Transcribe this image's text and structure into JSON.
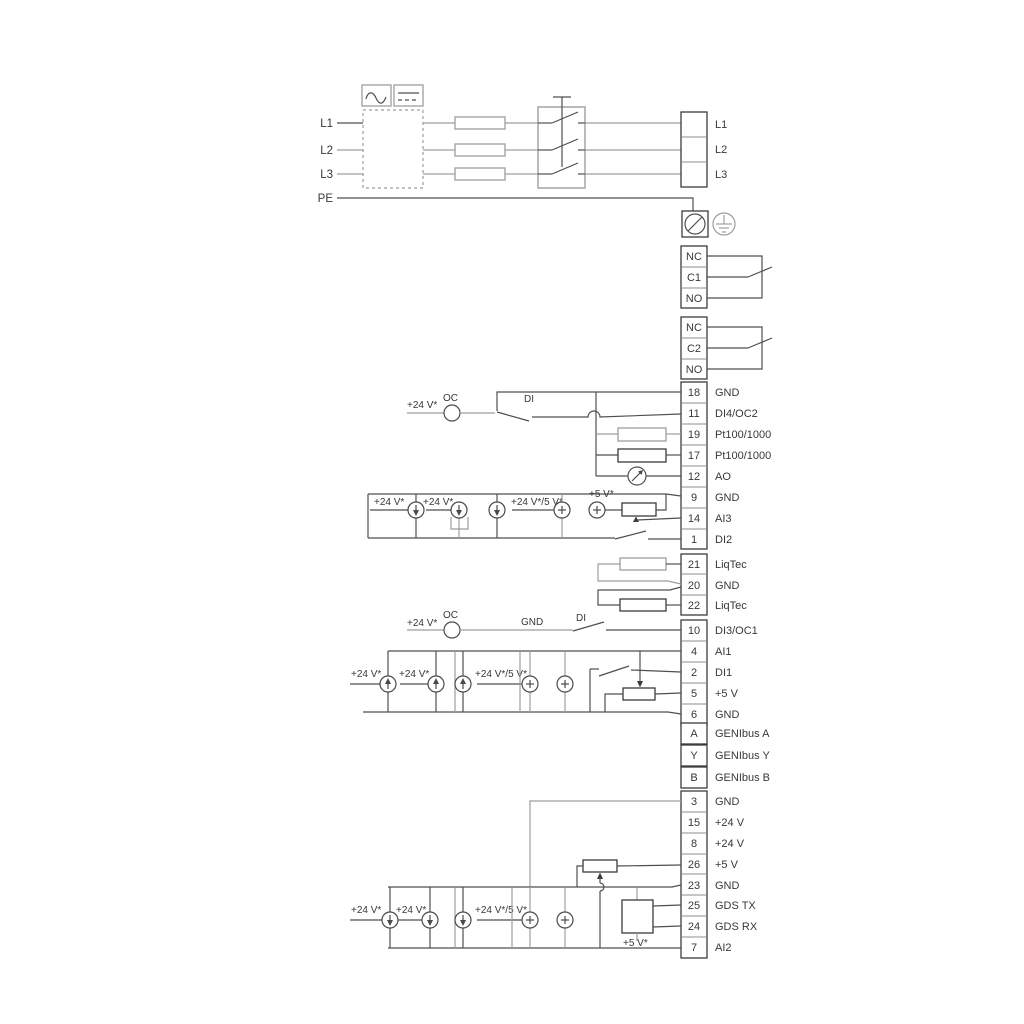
{
  "power": {
    "left": [
      "L1",
      "L2",
      "L3",
      "PE"
    ],
    "right": [
      "L1",
      "L2",
      "L3"
    ]
  },
  "relay1": {
    "terminals": [
      "NC",
      "C1",
      "NO"
    ]
  },
  "relay2": {
    "terminals": [
      "NC",
      "C2",
      "NO"
    ]
  },
  "strip1": {
    "terminals": [
      {
        "num": "18",
        "label": "GND"
      },
      {
        "num": "11",
        "label": "DI4/OC2"
      },
      {
        "num": "19",
        "label": "Pt100/1000"
      },
      {
        "num": "17",
        "label": "Pt100/1000"
      },
      {
        "num": "12",
        "label": "AO"
      },
      {
        "num": "9",
        "label": "GND"
      },
      {
        "num": "14",
        "label": "AI3"
      },
      {
        "num": "1",
        "label": "DI2"
      }
    ]
  },
  "liqtec": {
    "terminals": [
      {
        "num": "21",
        "label": "LiqTec"
      },
      {
        "num": "20",
        "label": "GND"
      },
      {
        "num": "22",
        "label": "LiqTec"
      }
    ]
  },
  "strip2": {
    "terminals": [
      {
        "num": "10",
        "label": "DI3/OC1"
      },
      {
        "num": "4",
        "label": "AI1"
      },
      {
        "num": "2",
        "label": "DI1"
      },
      {
        "num": "5",
        "label": "+5 V"
      },
      {
        "num": "6",
        "label": "GND"
      }
    ]
  },
  "genibus": {
    "terminals": [
      {
        "num": "A",
        "label": "GENIbus A"
      },
      {
        "num": "Y",
        "label": "GENIbus Y"
      },
      {
        "num": "B",
        "label": "GENIbus B"
      }
    ]
  },
  "strip3": {
    "terminals": [
      {
        "num": "3",
        "label": "GND"
      },
      {
        "num": "15",
        "label": "+24 V"
      },
      {
        "num": "8",
        "label": "+24 V"
      },
      {
        "num": "26",
        "label": "+5 V"
      },
      {
        "num": "23",
        "label": "GND"
      },
      {
        "num": "25",
        "label": "GDS TX"
      },
      {
        "num": "24",
        "label": "GDS RX"
      },
      {
        "num": "7",
        "label": "AI2"
      }
    ]
  },
  "annotations": {
    "di4_v24": "+24 V*",
    "di4_oc": "OC",
    "di4_di": "DI",
    "rowA_v24_1": "+24 V*",
    "rowA_v24_2": "+24 V*",
    "rowA_v24_5": "+24 V*/5 V*",
    "rowA_v5": "+5 V*",
    "di3_v24": "+24 V*",
    "di3_oc": "OC",
    "di3_gnd": "GND",
    "di3_di": "DI",
    "rowB_v24_1": "+24 V*",
    "rowB_v24_2": "+24 V*",
    "rowB_v24_5": "+24 V*/5 V*",
    "rowC_v24_1": "+24 V*",
    "rowC_v24_2": "+24 V*",
    "rowC_v24_5": "+24 V*/5 V*",
    "rowC_v5": "+5 V*"
  },
  "colors": {
    "wire": "#4f4f4f",
    "wire_light": "#9e9e9e",
    "text": "#383838"
  }
}
